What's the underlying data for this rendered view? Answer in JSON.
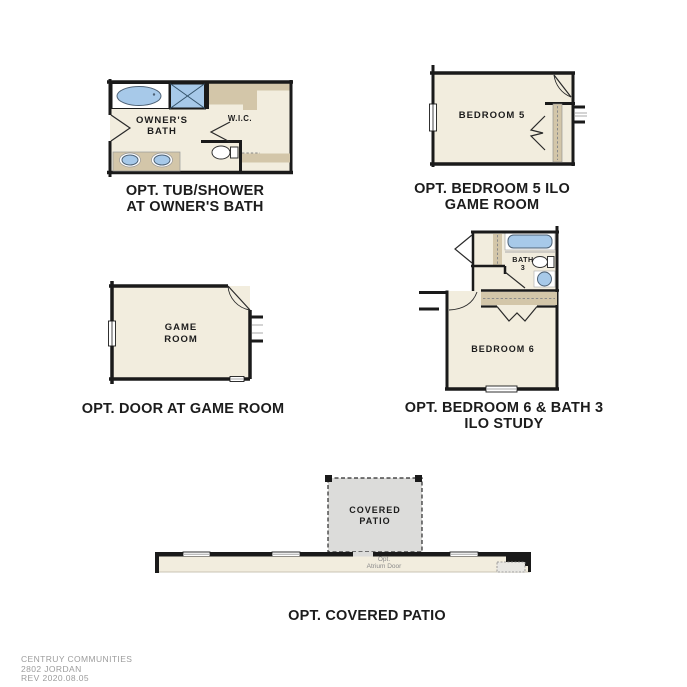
{
  "document": {
    "type_note": "floor plan options sheet",
    "background": "#ffffff"
  },
  "colors": {
    "wall_black": "#1a1a1a",
    "floor_cream": "#f2edde",
    "counter_tan": "#d3c6a9",
    "fixture_blue": "#a7c9e9",
    "patio_gray": "#dcdcda",
    "caption_text": "#1c1c1c",
    "footer_text": "#9c9c9c"
  },
  "plans": {
    "owners_bath": {
      "caption": [
        "OPT. TUB/SHOWER",
        "AT OWNER'S BATH"
      ],
      "labels": {
        "room": [
          "OWNER'S",
          "BATH"
        ],
        "closet": "W.I.C."
      }
    },
    "bedroom5": {
      "caption": [
        "OPT. BEDROOM 5 ILO",
        "GAME ROOM"
      ],
      "labels": {
        "room": "BEDROOM 5"
      }
    },
    "game_room": {
      "caption": [
        "OPT. DOOR AT GAME ROOM"
      ],
      "labels": {
        "room": [
          "GAME",
          "ROOM"
        ]
      }
    },
    "bedroom6_bath3": {
      "caption": [
        "OPT. BEDROOM 6 & BATH 3",
        "ILO STUDY"
      ],
      "labels": {
        "bath": [
          "BATH",
          "3"
        ],
        "bedroom": "BEDROOM 6"
      }
    },
    "covered_patio": {
      "caption": [
        "OPT. COVERED PATIO"
      ],
      "labels": {
        "patio": [
          "COVERED",
          "PATIO"
        ],
        "door_note": [
          "Opt.",
          "Atrium Door"
        ]
      }
    }
  },
  "footer": {
    "company": "CENTRUY COMMUNITIES",
    "plan_number": "2802 JORDAN",
    "revision": "REV 2020.08.05"
  }
}
